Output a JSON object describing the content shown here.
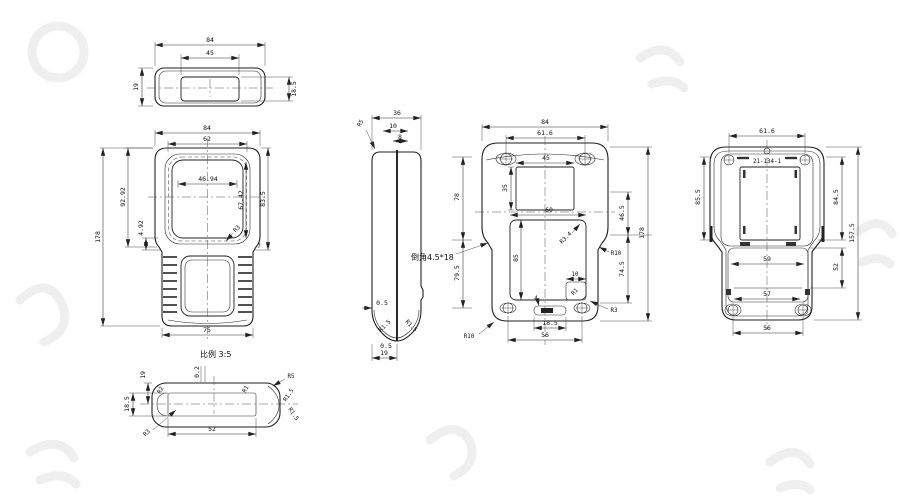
{
  "notes": {
    "scale": "比例 3:5",
    "chamfer": "倒角4.5*18",
    "part_number": "21-134-1"
  },
  "views": {
    "top": {
      "d84": "84",
      "d45": "45",
      "d19": "19",
      "d185": "18.5"
    },
    "front": {
      "d84": "84",
      "d62": "62",
      "d4694": "46.94",
      "d9292": "92.92",
      "d492": "4.92",
      "d178": "178",
      "d6742": "67.42",
      "d835": "83.5",
      "r3": "R3",
      "d7": "7",
      "d75": "75"
    },
    "detail": {
      "d19": "19",
      "d02": "0.2",
      "d185": "18.5",
      "d52": "52",
      "r5": "R5",
      "r15a": "R1.5",
      "r15b": "R1.5",
      "r3": "R3",
      "r2": "R2",
      "r1": "R1"
    },
    "side": {
      "d36": "36",
      "d10": "10",
      "d8": "8",
      "r5": "R5",
      "d05a": "0.5",
      "d05b": "0.5",
      "d19": "19",
      "r15a": "R1.5",
      "r15b": "R1.5",
      "d78": "78",
      "d795": "79.5"
    },
    "back": {
      "d84": "84",
      "d616": "61.6",
      "d45": "45",
      "d35": "35",
      "d60": "60",
      "r34": "R3.4",
      "d85": "85",
      "d10": "10",
      "r1": "R1",
      "d465": "46.5",
      "d745": "74.5",
      "d178": "178",
      "r10r": "R10",
      "r3": "R3",
      "d4": "4",
      "d185": "18.5",
      "d56": "56",
      "r10bl": "R10"
    },
    "rear": {
      "d616": "61.6",
      "d855": "85.5",
      "d845": "84.5",
      "d1575": "157.5",
      "d59": "59",
      "d52": "52",
      "d57": "57",
      "d56": "56"
    }
  }
}
